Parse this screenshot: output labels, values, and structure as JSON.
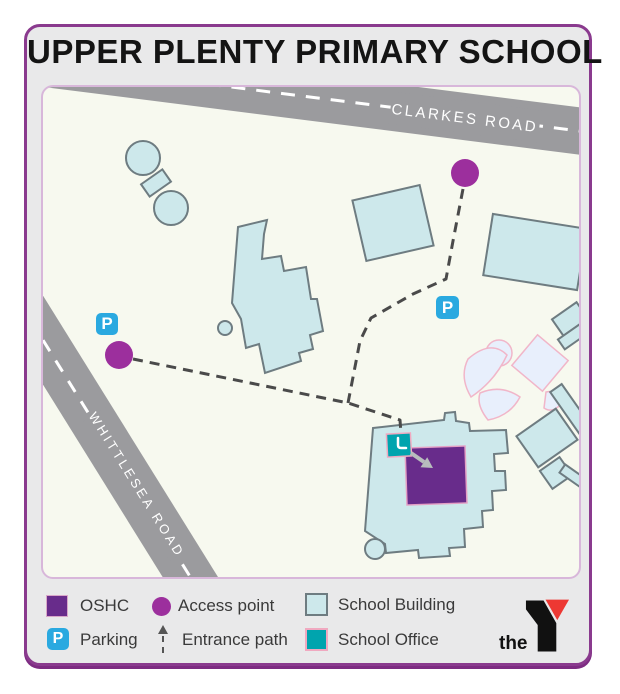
{
  "title": "UPPER PLENTY PRIMARY SCHOOL",
  "map": {
    "roads": [
      {
        "name": "CLARKES ROAD"
      },
      {
        "name": "WHITTLESEA ROAD"
      }
    ],
    "parking_glyph": "P"
  },
  "legend": {
    "items": [
      {
        "label": "OSHC",
        "swatch": "oshc-square"
      },
      {
        "label": "Access point",
        "swatch": "access-circle"
      },
      {
        "label": "School Building",
        "swatch": "building-square"
      },
      {
        "label": "Parking",
        "swatch": "parking-icon"
      },
      {
        "label": "Entrance path",
        "swatch": "entrance-arrow"
      },
      {
        "label": "School Office",
        "swatch": "office-square"
      }
    ]
  },
  "logo": {
    "prefix": "the",
    "letter": "Y"
  },
  "colors": {
    "frame": "#8a3a8e",
    "frame_shadow": "#7d2b82",
    "card_bg": "#e9e9ea",
    "map_bg": "#f7f9ef",
    "map_border": "#d8b7da",
    "road": "#9b9b9e",
    "building_fill": "#cde8eb",
    "building_stroke": "#6e7c81",
    "playground_fill": "#e8effc",
    "playground_stroke": "#f1b6c9",
    "oshc": "#682c8b",
    "school_office": "#00a4ae",
    "access_point": "#9c2f9d",
    "parking": "#2aa9e0",
    "path_dash": "#4a4a4a",
    "logo_red": "#ed3833"
  }
}
